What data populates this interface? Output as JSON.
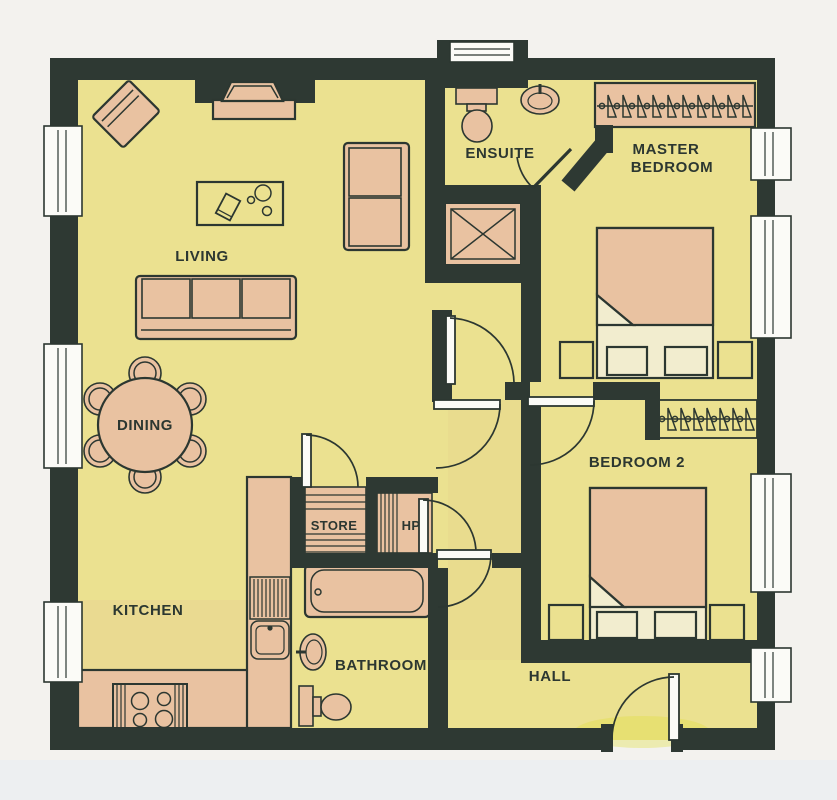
{
  "plan_type": "apartment-floor-plan",
  "rooms": {
    "living": {
      "label": "LIVING"
    },
    "dining": {
      "label": "DINING"
    },
    "kitchen": {
      "label": "KITCHEN"
    },
    "ensuite": {
      "label": "ENSUITE"
    },
    "master_bedroom": {
      "line1": "MASTER",
      "line2": "BEDROOM"
    },
    "bedroom2": {
      "label": "BEDROOM 2"
    },
    "hall": {
      "label": "HALL"
    },
    "store": {
      "label": "STORE"
    },
    "hot_press": {
      "label": "HP"
    },
    "bathroom": {
      "label": "BATHROOM"
    }
  },
  "colors": {
    "page": "#f3f2ee",
    "wall": "#2e3933",
    "line": "#2c3731",
    "floor": "#ebe190",
    "furniture": "#e9c2a1",
    "sheet": "#f2edcf",
    "window": "#fbfbf7",
    "threshold": "#dfdf3d"
  }
}
